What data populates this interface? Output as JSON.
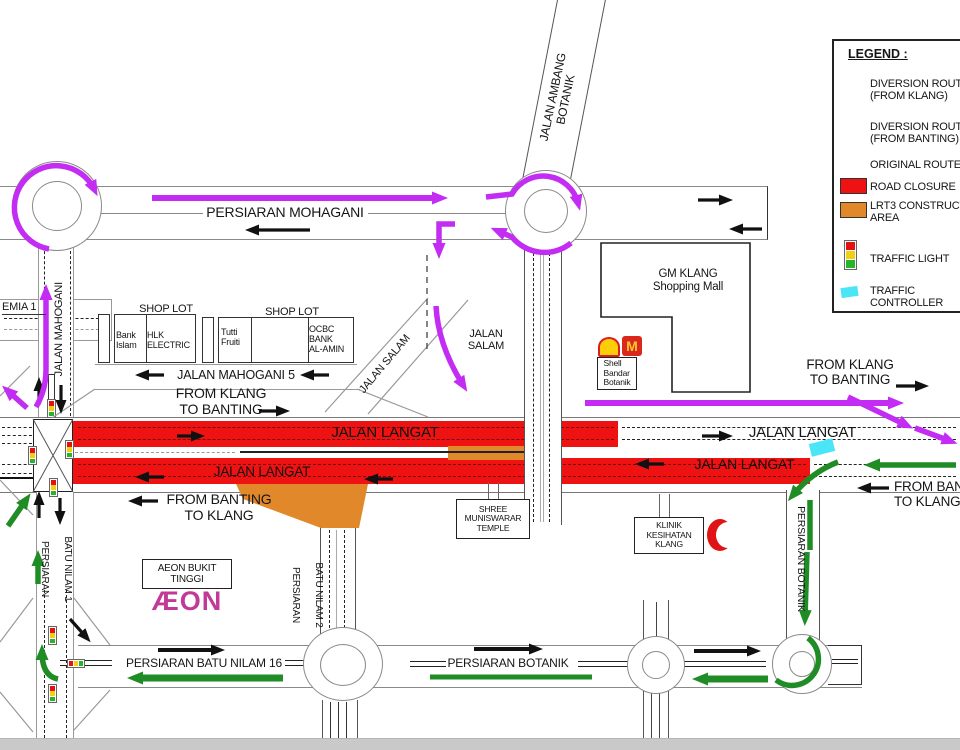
{
  "colors": {
    "c-magenta": "#c32cf2",
    "c-green": "#1f8c26",
    "c-red": "#ee1212",
    "c-orange": "#e1882b",
    "c-cyan": "#4ae5f7",
    "c-aeon": "#c23a97"
  },
  "legend": {
    "title": "LEGEND :",
    "items": [
      {
        "name": "diversion-route-klang",
        "label": "DIVERSION ROUTE\n(FROM KLANG)"
      },
      {
        "name": "diversion-route-banting",
        "label": "DIVERSION ROUTE\n(FROM BANTING)"
      },
      {
        "name": "original-route",
        "label": "ORIGINAL ROUTE"
      },
      {
        "name": "road-closure",
        "label": "ROAD CLOSURE"
      },
      {
        "name": "lrt3-construction-area",
        "label": "LRT3 CONSTRUCTION\nAREA"
      },
      {
        "name": "traffic-light",
        "label": "TRAFFIC LIGHT"
      },
      {
        "name": "traffic-controller",
        "label": "TRAFFIC\nCONTROLLER"
      }
    ]
  },
  "roads": {
    "persiaran_mohagani": "PERSIARAN MOHAGANI",
    "jalan_ambang_botanik": "JALAN AMBANG\nBOTANIK",
    "jalan_mahogani": "JALAN MAHOGANI",
    "jalan_mahogani_5": "JALAN MAHOGANI 5",
    "jalan_salam": "JALAN SALAM",
    "jalan_salam_2": "JALAN\nSALAM",
    "jalan_langat": "JALAN LANGAT",
    "persiaran_batu_nilam_1_a": "PERSIARAN",
    "persiaran_batu_nilam_1_b": "BATU NILAM 1",
    "persiaran_batu_nilam_2_a": "PERSIARAN",
    "persiaran_batu_nilam_2_b": "BATU NILAM 2",
    "persiaran_batu_nilam_16": "PERSIARAN BATU NILAM 16",
    "persiaran_botanik": "PERSIARAN BOTANIK",
    "akademia": "EMIA 1"
  },
  "directions": {
    "from_klang": "FROM KLANG\nTO BANTING",
    "from_banting": "FROM BANTING\nTO KLANG"
  },
  "places": {
    "shop_lot": "SHOP LOT",
    "bank_islam": "Bank\nIslam",
    "hlk_electric": "HLK\nELECTRIC",
    "tutti_fruiti": "Tutti\nFruiti",
    "ocbc": "OCBC\nBANK\nAL-AMIN",
    "gm_klang": "GM KLANG\nShopping Mall",
    "shell": "Shell\nBandar\nBotanik",
    "mcd": "M",
    "temple": "SHREE\nMUNISWARAR\nTEMPLE",
    "klinik": "KLINIK\nKESIHATAN\nKLANG",
    "aeon": "AEON BUKIT\nTINGGI",
    "aeon_logo": "ÆON"
  },
  "icons": {
    "traffic_light": "red-yellow-green-signal",
    "traffic_controller": "cyan-flag",
    "shell": "yellow-scallop-logo",
    "mcdonalds": "golden-arches-m",
    "red_crescent": "red-crescent"
  }
}
